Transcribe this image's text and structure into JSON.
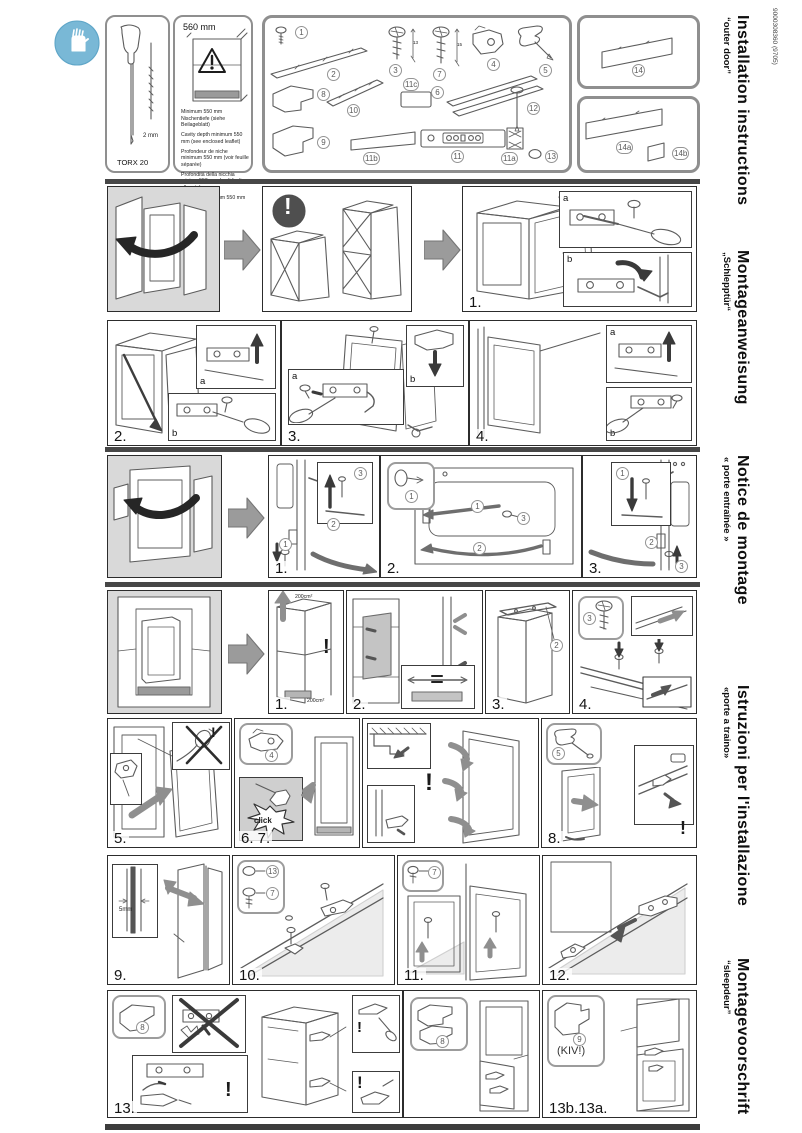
{
  "page": {
    "code": "9000308360 (9705)"
  },
  "headings": [
    {
      "title": "Installation instructions",
      "subtitle": "“outer door”"
    },
    {
      "title": "Montageanweisung",
      "subtitle": "„Schlepptür“"
    },
    {
      "title": "Notice de montage",
      "subtitle": "« porte entraînée »"
    },
    {
      "title": "Istruzioni per l'installazione",
      "subtitle": "«porte a traino»"
    },
    {
      "title": "Montagevoorschrift",
      "subtitle": "“sleepdeur”"
    }
  ],
  "tools": {
    "driver": "TORX 20",
    "bit": "2 mm"
  },
  "niche": {
    "depth": "560 mm",
    "notes": [
      "Minimum 550 mm Nischentiefe (siehe Beilageblatt)",
      "Cavity depth minimum 550 mm (see enclosed leaflet)",
      "Profondeur de niche minimum 550 mm (voir feuille séparée)",
      "Profondità della nicchia minimo 550 mm (vedi foglio allegato)",
      "Nisdiepte minimum 550 mm (zie bijlageblad)"
    ]
  },
  "parts": {
    "p1": "1",
    "p2": "2",
    "p3": "3",
    "p7": "7",
    "p4": "4",
    "p5": "5",
    "p8": "8",
    "p10": "10",
    "p11c": "11c",
    "p6": "6",
    "p12": "12",
    "p9": "9",
    "p11b": "11b",
    "p11": "11",
    "p11a": "11a",
    "p13": "13",
    "p14": "14",
    "p14a": "14a",
    "p14b": "14b",
    "dim3": "13",
    "dim7": "15"
  },
  "steps": {
    "s1": "1.",
    "s2": "2.",
    "s3": "3.",
    "s4": "4.",
    "d1": "1.",
    "d2": "2.",
    "d3": "3.",
    "n1": "1.",
    "n2": "2.",
    "n3": "3.",
    "n4": "4.",
    "s5": "5.",
    "s67": "6. 7.",
    "s8": "8.",
    "s9": "9.",
    "s10": "10.",
    "s11": "11.",
    "s12": "12.",
    "s13": "13.",
    "s13ab": "13b.13a."
  },
  "labels": {
    "a": "a",
    "b": "b",
    "c1": "1",
    "c2": "2",
    "c3": "3",
    "c4": "4",
    "c5": "5",
    "c7": "7",
    "c8": "8",
    "c9": "9",
    "c13": "13",
    "vent_top": "200cm²",
    "vent_bottom": "200cm²",
    "gap": "5mm",
    "click": "click",
    "kiv": "(KIV!)",
    "exclaim": "!"
  }
}
